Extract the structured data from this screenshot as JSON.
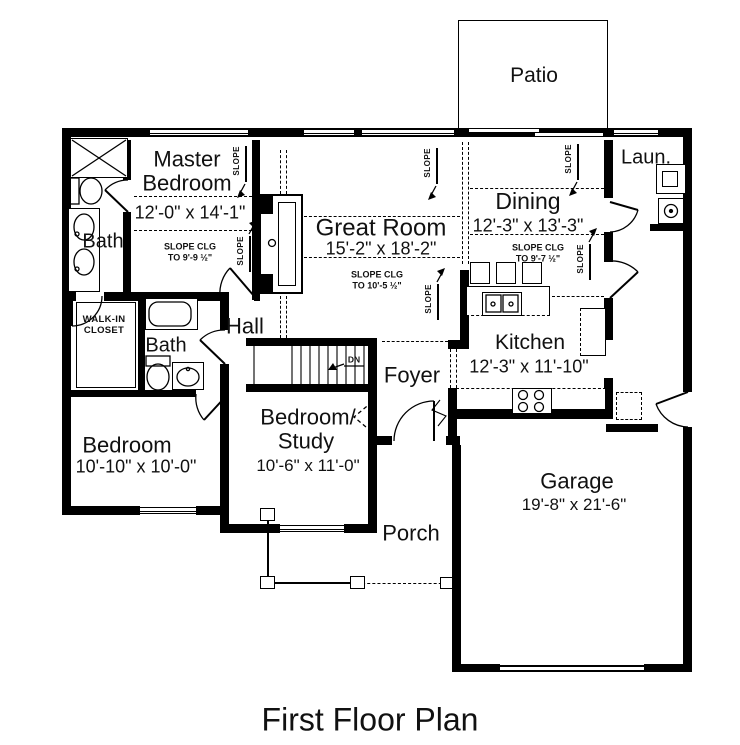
{
  "title": "First Floor Plan",
  "annotations": {
    "slope": "SLOPE",
    "down": "DN"
  },
  "rooms": {
    "patio": {
      "name": "Patio"
    },
    "master_bedroom": {
      "name1": "Master",
      "name2": "Bedroom",
      "dims": "12'-0\" x 14'-1\"",
      "slope1": "SLOPE CLG",
      "slope2": "TO 9'-9 ½\""
    },
    "master_bath": {
      "name": "Bath"
    },
    "great_room": {
      "name": "Great Room",
      "dims": "15'-2\" x 18'-2\"",
      "slope1": "SLOPE CLG",
      "slope2": "TO 10'-5 ½\""
    },
    "dining": {
      "name": "Dining",
      "dims": "12'-3\" x 13'-3\"",
      "slope1": "SLOPE CLG",
      "slope2": "TO 9'-7 ½\""
    },
    "laundry": {
      "name": "Laun."
    },
    "kitchen": {
      "name": "Kitchen",
      "dims": "12'-3\" x 11'-10\""
    },
    "walk_in_closet": {
      "name1": "WALK-IN",
      "name2": "CLOSET"
    },
    "hall": {
      "name": "Hall"
    },
    "bath2": {
      "name": "Bath"
    },
    "foyer": {
      "name": "Foyer"
    },
    "bedroom": {
      "name": "Bedroom",
      "dims": "10'-10\" x 10'-0\""
    },
    "bedroom_study": {
      "name1": "Bedroom/",
      "name2": "Study",
      "dims": "10'-6\" x 11'-0\""
    },
    "porch": {
      "name": "Porch"
    },
    "garage": {
      "name": "Garage",
      "dims": "19'-8\" x 21'-6\""
    }
  },
  "colors": {
    "wall": "#000000",
    "background": "#ffffff",
    "text": "#111111"
  }
}
